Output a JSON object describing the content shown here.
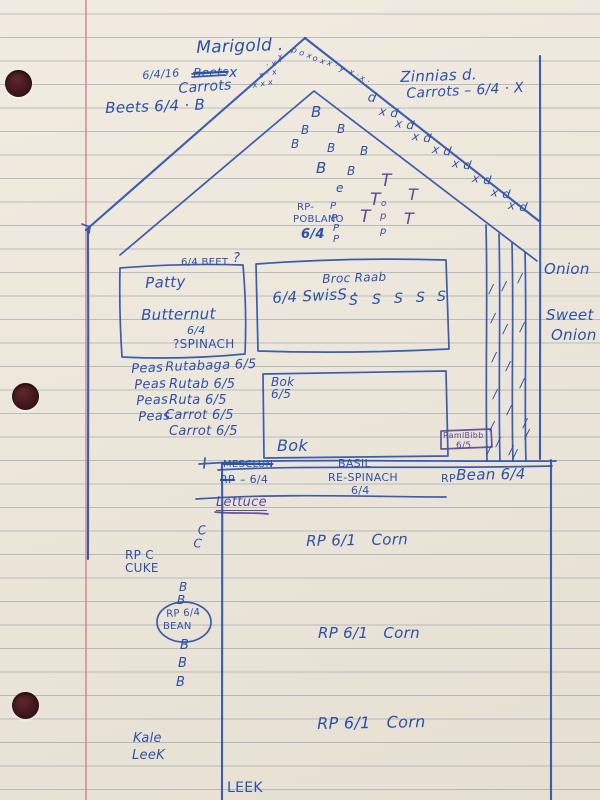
{
  "colors": {
    "ink_blue": "#2b51a8",
    "ink_purple": "#5e4796",
    "margin_red": "#c9858c",
    "rule_gray": "#7d8c98",
    "paper": "#ece6db"
  },
  "labels": [
    {
      "t": "Marigold .",
      "x": 196,
      "y": 40,
      "fs": 17,
      "r": -2
    },
    {
      "t": "6/4/16",
      "x": 142,
      "y": 70,
      "fs": 11,
      "r": -4
    },
    {
      "t": "Beets",
      "x": 193,
      "y": 67,
      "fs": 12,
      "cls": "strike",
      "r": -2
    },
    {
      "t": "x",
      "x": 229,
      "y": 66,
      "fs": 14
    },
    {
      "t": "Carrots",
      "x": 178,
      "y": 82,
      "fs": 14,
      "r": -4
    },
    {
      "t": "Beets 6/4 · B",
      "x": 105,
      "y": 101,
      "fs": 15,
      "r": -2
    },
    {
      "t": "Zinnias d.",
      "x": 400,
      "y": 70,
      "fs": 15,
      "r": -2
    },
    {
      "t": "Carrots – 6/4 · X",
      "x": 406,
      "y": 87,
      "fs": 14,
      "r": -3
    },
    {
      "t": "x x x",
      "x": 252,
      "y": 82,
      "fs": 8,
      "r": -10
    },
    {
      "t": "x · x",
      "x": 258,
      "y": 72,
      "fs": 8,
      "r": -12
    },
    {
      "t": "· x ·",
      "x": 265,
      "y": 62,
      "fs": 8,
      "r": -14
    },
    {
      "t": "x ·",
      "x": 277,
      "y": 54,
      "fs": 8,
      "r": -16
    },
    {
      "t": "p o x",
      "x": 293,
      "y": 46,
      "fs": 8,
      "r": 20
    },
    {
      "t": "· o x ·",
      "x": 309,
      "y": 52,
      "fs": 8,
      "r": 22
    },
    {
      "t": "x · y ·",
      "x": 329,
      "y": 59,
      "fs": 8,
      "r": 24
    },
    {
      "t": "x ·",
      "x": 351,
      "y": 68,
      "fs": 8,
      "r": 26
    },
    {
      "t": "x ·",
      "x": 362,
      "y": 74,
      "fs": 8,
      "r": 28
    },
    {
      "t": "d",
      "x": 369,
      "y": 91,
      "fs": 13,
      "r": 10
    },
    {
      "t": "x d",
      "x": 380,
      "y": 105,
      "fs": 12,
      "r": 8
    },
    {
      "t": "x d",
      "x": 396,
      "y": 117,
      "fs": 12,
      "r": 8
    },
    {
      "t": "x d",
      "x": 413,
      "y": 130,
      "fs": 12,
      "r": 8
    },
    {
      "t": "x d",
      "x": 433,
      "y": 143,
      "fs": 12,
      "r": 8
    },
    {
      "t": "x d",
      "x": 453,
      "y": 157,
      "fs": 12,
      "r": 8
    },
    {
      "t": "x d",
      "x": 473,
      "y": 172,
      "fs": 12,
      "r": 8
    },
    {
      "t": "x d",
      "x": 492,
      "y": 186,
      "fs": 12,
      "r": 8
    },
    {
      "t": "x d",
      "x": 509,
      "y": 199,
      "fs": 12,
      "r": 8
    },
    {
      "t": "B",
      "x": 311,
      "y": 105,
      "fs": 15
    },
    {
      "t": "B",
      "x": 301,
      "y": 124,
      "fs": 12
    },
    {
      "t": "B",
      "x": 337,
      "y": 123,
      "fs": 12
    },
    {
      "t": "B",
      "x": 291,
      "y": 138,
      "fs": 12
    },
    {
      "t": "B",
      "x": 327,
      "y": 142,
      "fs": 12
    },
    {
      "t": "B",
      "x": 360,
      "y": 145,
      "fs": 12
    },
    {
      "t": "B",
      "x": 316,
      "y": 161,
      "fs": 15
    },
    {
      "t": "B",
      "x": 347,
      "y": 165,
      "fs": 12
    },
    {
      "t": "e",
      "x": 336,
      "y": 182,
      "fs": 12
    },
    {
      "t": "T",
      "x": 381,
      "y": 173,
      "fs": 17,
      "c": "p"
    },
    {
      "t": "T",
      "x": 408,
      "y": 187,
      "fs": 16,
      "c": "p"
    },
    {
      "t": "T",
      "x": 370,
      "y": 192,
      "fs": 17,
      "c": "p"
    },
    {
      "t": "T",
      "x": 360,
      "y": 209,
      "fs": 17,
      "c": "p"
    },
    {
      "t": "T",
      "x": 404,
      "y": 211,
      "fs": 16,
      "c": "p"
    },
    {
      "t": "o",
      "x": 381,
      "y": 200,
      "fs": 9,
      "c": "p"
    },
    {
      "t": "p",
      "x": 380,
      "y": 212,
      "fs": 10,
      "c": "p"
    },
    {
      "t": "p",
      "x": 380,
      "y": 227,
      "fs": 10
    },
    {
      "t": "P",
      "x": 330,
      "y": 202,
      "fs": 10
    },
    {
      "t": "P",
      "x": 331,
      "y": 214,
      "fs": 10
    },
    {
      "t": "P",
      "x": 333,
      "y": 224,
      "fs": 10
    },
    {
      "t": "P",
      "x": 333,
      "y": 235,
      "fs": 10
    },
    {
      "t": "RP-",
      "x": 297,
      "y": 203,
      "fs": 10,
      "cls": "pr"
    },
    {
      "t": "POBLANO",
      "x": 293,
      "y": 215,
      "fs": 10,
      "cls": "pr"
    },
    {
      "t": "6/4",
      "x": 301,
      "y": 228,
      "fs": 13,
      "cls": "bold"
    },
    {
      "t": "6/4 BEET",
      "x": 181,
      "y": 258,
      "fs": 10,
      "cls": "pr"
    },
    {
      "t": "?",
      "x": 233,
      "y": 252,
      "fs": 13
    },
    {
      "t": "Patty",
      "x": 145,
      "y": 276,
      "fs": 15,
      "r": -2
    },
    {
      "t": "Butternut",
      "x": 141,
      "y": 308,
      "fs": 15,
      "r": -1
    },
    {
      "t": "6/4",
      "x": 187,
      "y": 325,
      "fs": 11
    },
    {
      "t": "?SPINACH",
      "x": 173,
      "y": 338,
      "fs": 12,
      "cls": "pr"
    },
    {
      "t": "Broc Raab",
      "x": 322,
      "y": 273,
      "fs": 12,
      "r": -2
    },
    {
      "t": "6/4 SwisS ·",
      "x": 272,
      "y": 291,
      "fs": 15,
      "r": -3
    },
    {
      "t": "S",
      "x": 349,
      "y": 294,
      "fs": 14
    },
    {
      "t": "S",
      "x": 372,
      "y": 293,
      "fs": 14
    },
    {
      "t": "S",
      "x": 394,
      "y": 292,
      "fs": 14
    },
    {
      "t": "S",
      "x": 416,
      "y": 291,
      "fs": 14
    },
    {
      "t": "S",
      "x": 437,
      "y": 290,
      "fs": 14
    },
    {
      "t": "Peas",
      "x": 131,
      "y": 363,
      "fs": 13,
      "r": -3
    },
    {
      "t": "Rutabaga 6/5",
      "x": 165,
      "y": 361,
      "fs": 13,
      "r": -2
    },
    {
      "t": "Peas",
      "x": 134,
      "y": 379,
      "fs": 13,
      "r": -3
    },
    {
      "t": "Rutab 6/5",
      "x": 169,
      "y": 378,
      "fs": 13
    },
    {
      "t": "Peas",
      "x": 136,
      "y": 395,
      "fs": 13,
      "r": -3
    },
    {
      "t": "Ruta 6/5",
      "x": 169,
      "y": 394,
      "fs": 13
    },
    {
      "t": "Peas",
      "x": 138,
      "y": 411,
      "fs": 13,
      "r": -3
    },
    {
      "t": "Carrot 6/5",
      "x": 165,
      "y": 409,
      "fs": 13
    },
    {
      "t": "Carrot 6/5",
      "x": 169,
      "y": 425,
      "fs": 13
    },
    {
      "t": "Bok",
      "x": 271,
      "y": 376,
      "fs": 12
    },
    {
      "t": "6/5",
      "x": 271,
      "y": 388,
      "fs": 12
    },
    {
      "t": "Bok",
      "x": 277,
      "y": 438,
      "fs": 16
    },
    {
      "t": "RamlBibb",
      "x": 443,
      "y": 432,
      "fs": 8,
      "c": "p",
      "cls": "pr"
    },
    {
      "t": "6/5",
      "x": 456,
      "y": 442,
      "fs": 9,
      "c": "p",
      "cls": "pr"
    },
    {
      "t": "Onion",
      "x": 544,
      "y": 262,
      "fs": 15
    },
    {
      "t": "Sweet",
      "x": 546,
      "y": 308,
      "fs": 15
    },
    {
      "t": "Onion",
      "x": 551,
      "y": 328,
      "fs": 15
    },
    {
      "t": "/",
      "x": 489,
      "y": 283,
      "fs": 12
    },
    {
      "t": "/",
      "x": 502,
      "y": 280,
      "fs": 12
    },
    {
      "t": "/",
      "x": 518,
      "y": 272,
      "fs": 12
    },
    {
      "t": "/",
      "x": 491,
      "y": 312,
      "fs": 12
    },
    {
      "t": "/",
      "x": 503,
      "y": 323,
      "fs": 12
    },
    {
      "t": "/",
      "x": 520,
      "y": 321,
      "fs": 12
    },
    {
      "t": "/",
      "x": 492,
      "y": 351,
      "fs": 12
    },
    {
      "t": "/",
      "x": 506,
      "y": 360,
      "fs": 12
    },
    {
      "t": "/",
      "x": 520,
      "y": 377,
      "fs": 12
    },
    {
      "t": "/",
      "x": 493,
      "y": 388,
      "fs": 12
    },
    {
      "t": "/",
      "x": 507,
      "y": 404,
      "fs": 12
    },
    {
      "t": "/",
      "x": 523,
      "y": 417,
      "fs": 12
    },
    {
      "t": "/",
      "x": 490,
      "y": 420,
      "fs": 12
    },
    {
      "t": "/",
      "x": 496,
      "y": 436,
      "fs": 12
    },
    {
      "t": "/",
      "x": 509,
      "y": 444,
      "fs": 12
    },
    {
      "t": "/",
      "x": 525,
      "y": 428,
      "fs": 12
    },
    {
      "t": "/",
      "x": 487,
      "y": 444,
      "fs": 12
    },
    {
      "t": "/",
      "x": 513,
      "y": 448,
      "fs": 12
    },
    {
      "t": "MESCLUN",
      "x": 223,
      "y": 460,
      "fs": 10,
      "cls": "pr strike"
    },
    {
      "t": "RP",
      "x": 220,
      "y": 474,
      "fs": 11,
      "cls": "pr strike"
    },
    {
      "t": "– 6/4",
      "x": 240,
      "y": 474,
      "fs": 11,
      "cls": "pr"
    },
    {
      "t": "Lettuce",
      "x": 216,
      "y": 496,
      "fs": 13,
      "c": "p",
      "cls": "und"
    },
    {
      "t": "BASIL",
      "x": 338,
      "y": 458,
      "fs": 11,
      "cls": "pr"
    },
    {
      "t": "RE-SPINACH",
      "x": 328,
      "y": 472,
      "fs": 11,
      "cls": "pr"
    },
    {
      "t": "6/4",
      "x": 351,
      "y": 485,
      "fs": 11,
      "cls": "pr"
    },
    {
      "t": "RP",
      "x": 441,
      "y": 473,
      "fs": 11,
      "cls": "pr"
    },
    {
      "t": "Bean 6/4",
      "x": 456,
      "y": 468,
      "fs": 15,
      "r": -1
    },
    {
      "t": "RP 6/1   Corn",
      "x": 306,
      "y": 534,
      "fs": 15,
      "r": -1
    },
    {
      "t": "RP 6/1   Corn",
      "x": 318,
      "y": 626,
      "fs": 15
    },
    {
      "t": "RP 6/1   Corn",
      "x": 317,
      "y": 716,
      "fs": 16,
      "r": -1
    },
    {
      "t": "C",
      "x": 197,
      "y": 525,
      "fs": 12,
      "r": -8
    },
    {
      "t": "C",
      "x": 194,
      "y": 537,
      "fs": 12,
      "r": 5
    },
    {
      "t": "RP C",
      "x": 125,
      "y": 549,
      "fs": 12,
      "cls": "pr"
    },
    {
      "t": "CUKE",
      "x": 125,
      "y": 562,
      "fs": 12,
      "cls": "pr"
    },
    {
      "t": "B",
      "x": 179,
      "y": 581,
      "fs": 12
    },
    {
      "t": "B",
      "x": 177,
      "y": 594,
      "fs": 12
    },
    {
      "t": "RP 6/4",
      "x": 166,
      "y": 610,
      "fs": 10,
      "cls": "pr",
      "r": -3
    },
    {
      "t": "BEAN",
      "x": 163,
      "y": 622,
      "fs": 10,
      "cls": "pr"
    },
    {
      "t": "B",
      "x": 180,
      "y": 639,
      "fs": 13
    },
    {
      "t": "B",
      "x": 178,
      "y": 657,
      "fs": 13
    },
    {
      "t": "B",
      "x": 176,
      "y": 676,
      "fs": 13
    },
    {
      "t": "Kale",
      "x": 133,
      "y": 732,
      "fs": 13
    },
    {
      "t": "LeeK",
      "x": 132,
      "y": 749,
      "fs": 13
    },
    {
      "t": "LEEK",
      "x": 227,
      "y": 781,
      "fs": 14,
      "cls": "pr"
    }
  ]
}
